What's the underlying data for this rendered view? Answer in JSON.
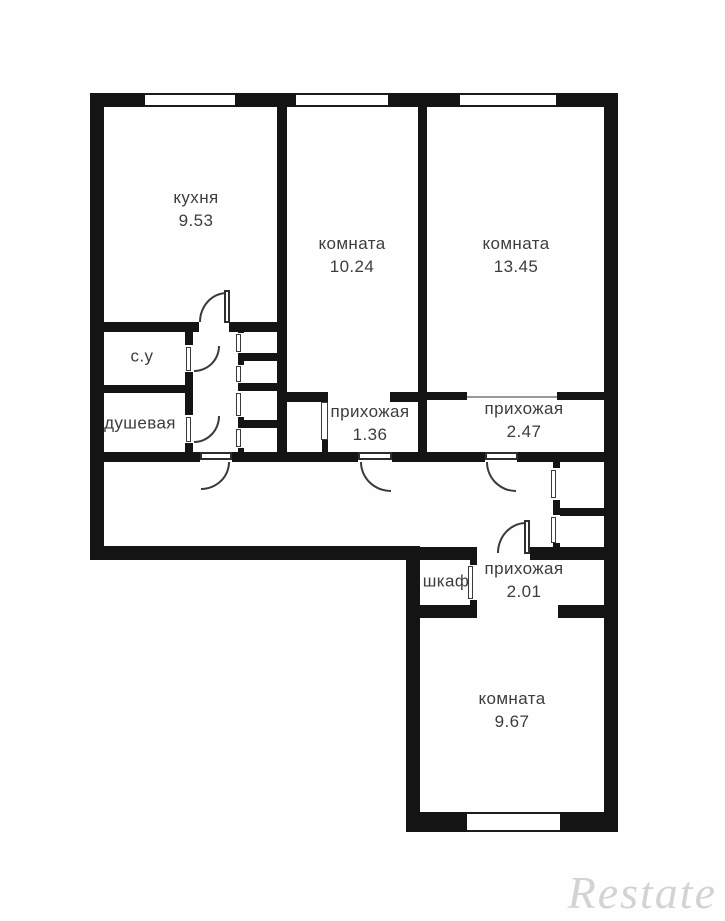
{
  "plan": {
    "title": "apartment-floor-plan",
    "rooms": [
      {
        "id": "kitchen",
        "label": "кухня",
        "area": "9.53"
      },
      {
        "id": "room-a",
        "label": "комната",
        "area": "10.24"
      },
      {
        "id": "room-b",
        "label": "комната",
        "area": "13.45"
      },
      {
        "id": "wc",
        "label": "с.у",
        "area": ""
      },
      {
        "id": "shower",
        "label": "душевая",
        "area": ""
      },
      {
        "id": "hall-a",
        "label": "прихожая",
        "area": "1.36"
      },
      {
        "id": "hall-b",
        "label": "прихожая",
        "area": "2.47"
      },
      {
        "id": "closet",
        "label": "шкаф",
        "area": ""
      },
      {
        "id": "hall-c",
        "label": "прихожая",
        "area": "2.01"
      },
      {
        "id": "room-c",
        "label": "комната",
        "area": "9.67"
      }
    ],
    "watermark": "Restate",
    "colors": {
      "wall": "#141414",
      "background": "#fefefe",
      "label_text": "#3d3d3d",
      "watermark_text": "#cccccc"
    }
  }
}
